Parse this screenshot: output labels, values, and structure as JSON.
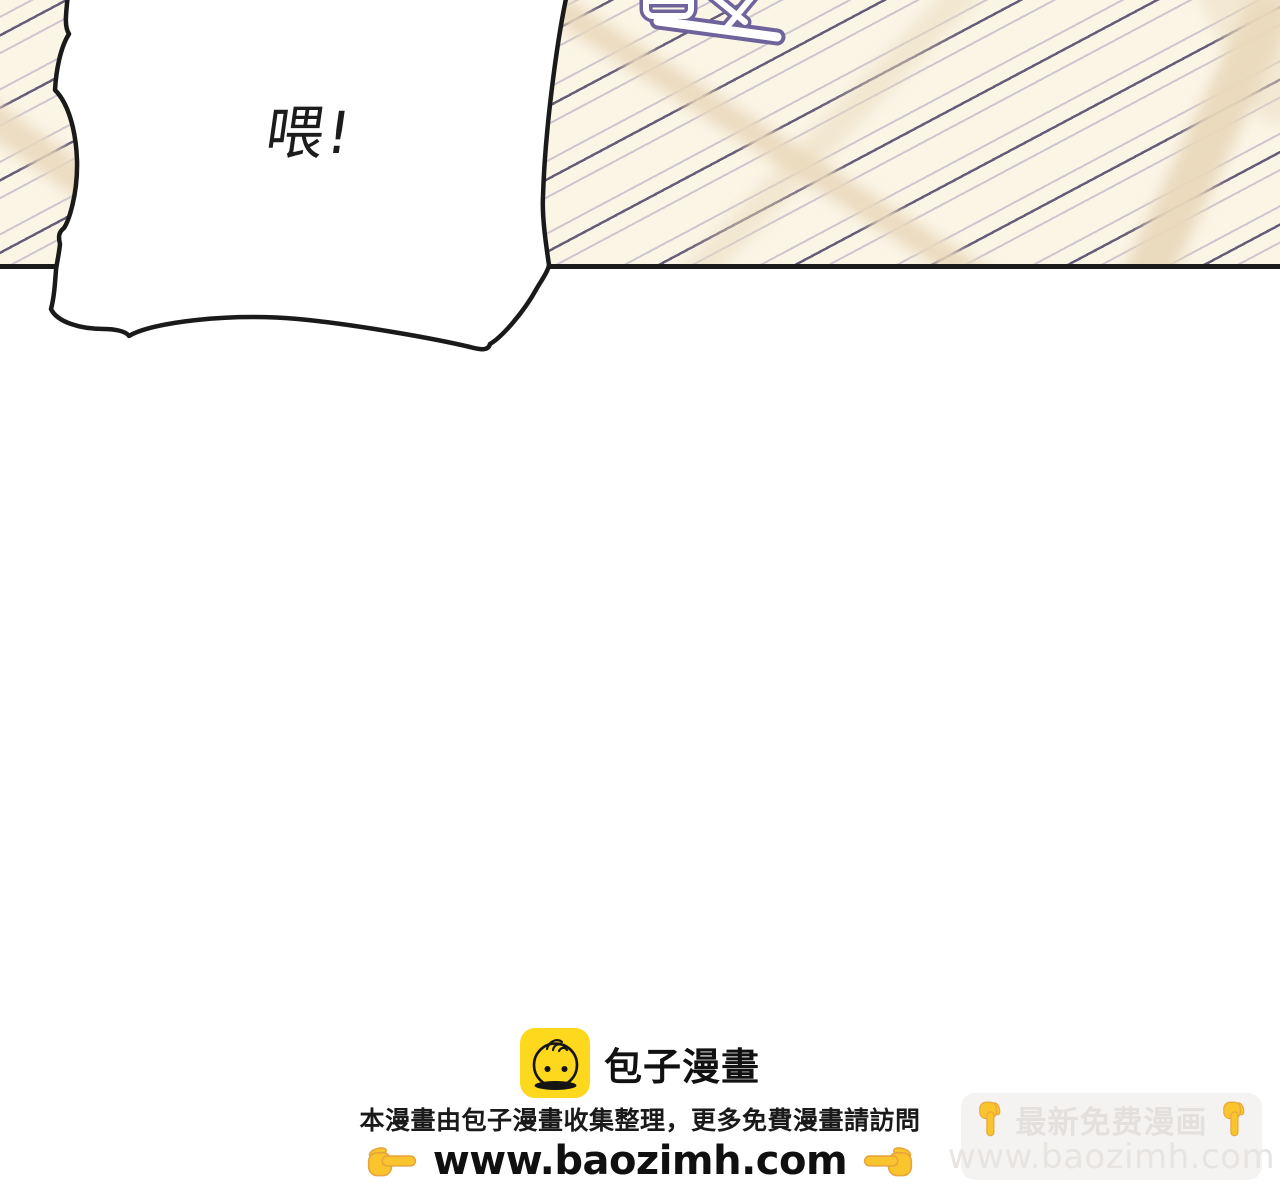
{
  "panel": {
    "speech_bubble": {
      "text": "喂!"
    },
    "sfx": {
      "description": "cropped purple impact lettering at top edge"
    },
    "colors": {
      "background": "#fbf5e6",
      "hatch_line": "#4c4366",
      "light_streak": "#e9d9bc",
      "border_line": "#1a1a1a",
      "sfx_outline": "#6f639b",
      "bubble_fill": "#ffffff",
      "bubble_outline": "#1a1a1a"
    }
  },
  "footer": {
    "logo_text": "包子漫畫",
    "info_line": "本漫畫由包子漫畫收集整理，更多免費漫畫請訪問",
    "url": "www.baozimh.com",
    "colors": {
      "logo_yellow": "#fed81c",
      "hand_yellow": "#fac42c",
      "text": "#111111"
    }
  },
  "corner_watermark": {
    "title": "最新免费漫画",
    "url": "www.baozimh.com",
    "colors": {
      "box": "#f4f3f2",
      "text": "#e4e0de",
      "hand_yellow": "#fac42c"
    }
  }
}
